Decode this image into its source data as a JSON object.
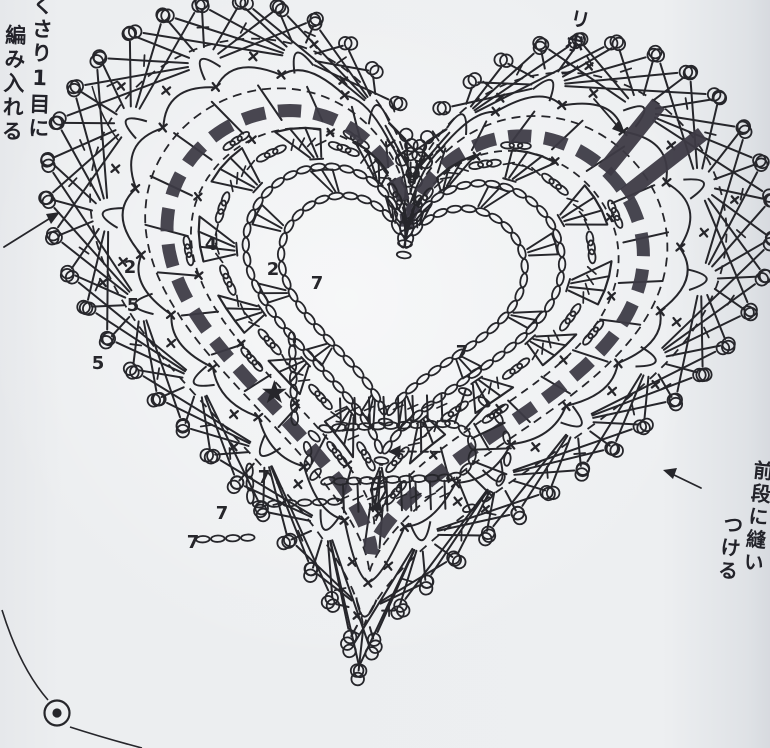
{
  "title": "heart-motif crochet chart (scanned Japanese pattern diagram)",
  "palette": {
    "paper": "#e9ebee",
    "ink": "#26262b",
    "ribbon": "#3d3a45"
  },
  "labels": {
    "top_left_line1": "くさり1目に",
    "top_left_line2": "編み入れる",
    "ribbon": "リボン",
    "right_line1": "前段に縫い",
    "right_line2": "つける"
  },
  "center": {
    "star": "★"
  },
  "round_numbers": [
    {
      "value": "4",
      "x": 211,
      "y": 250
    },
    {
      "value": "2",
      "x": 273,
      "y": 275
    },
    {
      "value": "7",
      "x": 317,
      "y": 289
    },
    {
      "value": "7",
      "x": 462,
      "y": 358
    },
    {
      "value": "2",
      "x": 130,
      "y": 273
    },
    {
      "value": "5",
      "x": 133,
      "y": 311
    },
    {
      "value": "5",
      "x": 98,
      "y": 369
    },
    {
      "value": "7",
      "x": 264,
      "y": 483
    },
    {
      "value": "7",
      "x": 222,
      "y": 519
    },
    {
      "value": "7",
      "x": 193,
      "y": 548
    }
  ],
  "stitch_symbols": {
    "chain": "small-oval",
    "single_crochet": "x-mark",
    "double_crochet": "post-with-tick",
    "picot_loop": "teardrop-loop",
    "shell_fan": "radiating-spokes",
    "start_marker": "filled-star",
    "ribbon_weave": "bold-dashed-band",
    "join_marker": "circled-dot"
  }
}
